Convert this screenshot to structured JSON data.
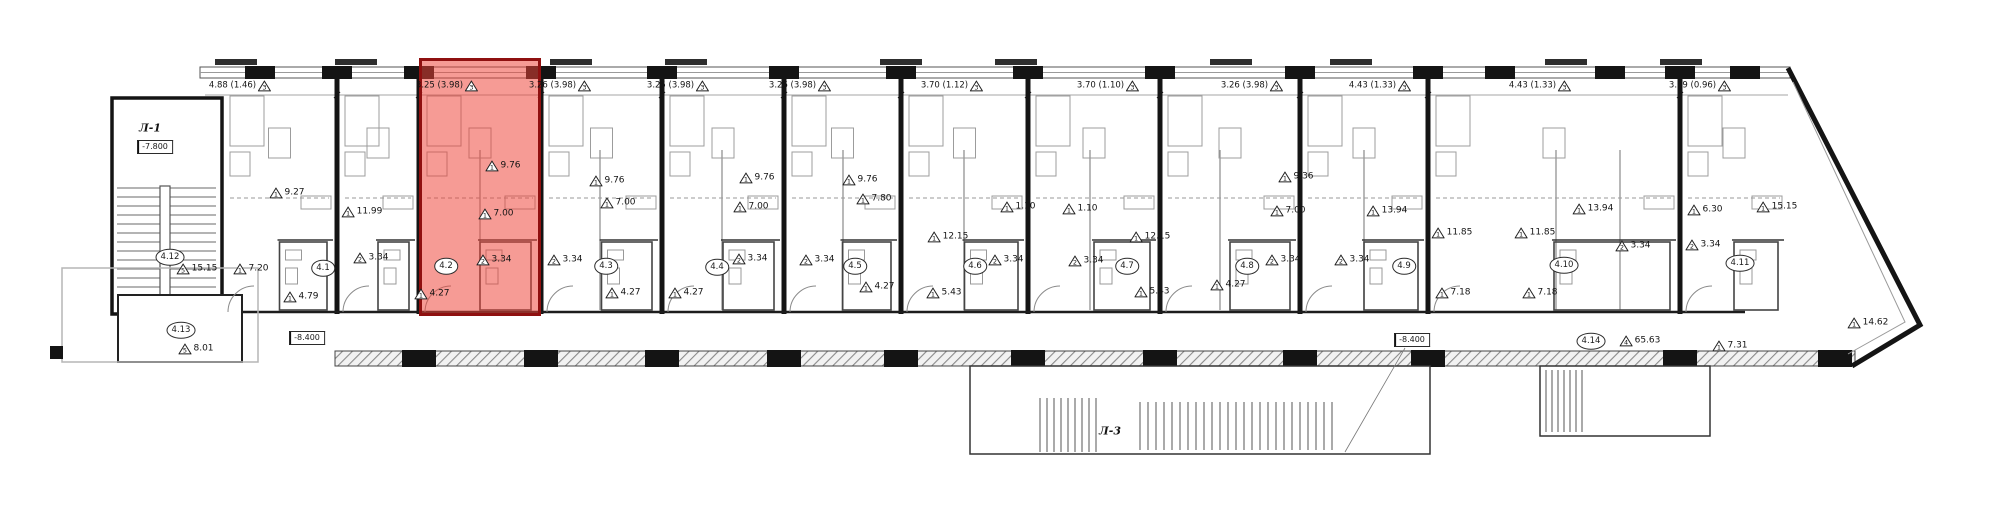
{
  "plan_title": "floor-plan-with-highlighted-unit",
  "highlighted_unit": {
    "id": "4.2",
    "fill_color": "#ee4438",
    "border_color": "#8f1010",
    "fill_opacity": 0.5
  },
  "stairwells": {
    "left": {
      "label": "Л-1",
      "elevation": "-7.800",
      "x": 150,
      "y": 128,
      "elev_x": 155,
      "elev_y": 147
    },
    "bottom": {
      "label": "Л-3",
      "x": 1110,
      "y": 431
    }
  },
  "elevations": [
    {
      "text": "-8.400",
      "x": 307,
      "y": 338
    },
    {
      "text": "-8.400",
      "x": 1412,
      "y": 340
    }
  ],
  "top_dimensions": [
    {
      "text": "4.88 (1.46)",
      "tri": "3",
      "x": 240
    },
    {
      "text": "3.25 (3.98)",
      "tri": "3",
      "x": 447
    },
    {
      "text": "3.26 (3.98)",
      "tri": "3",
      "x": 560
    },
    {
      "text": "3.25 (3.98)",
      "tri": "3",
      "x": 678
    },
    {
      "text": "3.26 (3.98)",
      "tri": "3",
      "x": 800
    },
    {
      "text": "3.70 (1.12)",
      "tri": "3",
      "x": 952
    },
    {
      "text": "3.70 (1.10)",
      "tri": "3",
      "x": 1108
    },
    {
      "text": "3.26 (3.98)",
      "tri": "3",
      "x": 1252
    },
    {
      "text": "4.43 (1.33)",
      "tri": "3",
      "x": 1380
    },
    {
      "text": "4.43 (1.33)",
      "tri": "3",
      "x": 1540
    },
    {
      "text": "3.99 (0.96)",
      "tri": "3",
      "x": 1700
    }
  ],
  "unit_markers": [
    {
      "id": "4.1",
      "x": 323,
      "y": 268
    },
    {
      "id": "4.2",
      "x": 446,
      "y": 266
    },
    {
      "id": "4.3",
      "x": 606,
      "y": 266
    },
    {
      "id": "4.4",
      "x": 717,
      "y": 267
    },
    {
      "id": "4.5",
      "x": 855,
      "y": 266
    },
    {
      "id": "4.6",
      "x": 975,
      "y": 266
    },
    {
      "id": "4.7",
      "x": 1127,
      "y": 266
    },
    {
      "id": "4.8",
      "x": 1247,
      "y": 266
    },
    {
      "id": "4.9",
      "x": 1404,
      "y": 266
    },
    {
      "id": "4.10",
      "x": 1564,
      "y": 265
    },
    {
      "id": "4.11",
      "x": 1740,
      "y": 263
    },
    {
      "id": "4.12",
      "x": 170,
      "y": 257
    },
    {
      "id": "4.13",
      "x": 181,
      "y": 330
    },
    {
      "id": "4.14",
      "x": 1591,
      "y": 341
    }
  ],
  "area_labels": [
    {
      "tri": "1",
      "text": "9.27",
      "x": 287,
      "y": 193
    },
    {
      "tri": "1",
      "text": "11.99",
      "x": 362,
      "y": 212
    },
    {
      "tri": "1",
      "text": "7.20",
      "x": 251,
      "y": 269
    },
    {
      "tri": "1",
      "text": "4.79",
      "x": 301,
      "y": 297
    },
    {
      "tri": "2",
      "text": "3.34",
      "x": 371,
      "y": 258
    },
    {
      "tri": "5",
      "text": "15.15",
      "x": 197,
      "y": 269
    },
    {
      "tri": "5",
      "text": "8.01",
      "x": 196,
      "y": 349
    },
    {
      "tri": "1",
      "text": "9.76",
      "x": 503,
      "y": 166
    },
    {
      "tri": "1",
      "text": "7.00",
      "x": 496,
      "y": 214
    },
    {
      "tri": "2",
      "text": "3.34",
      "x": 494,
      "y": 260
    },
    {
      "tri": "1",
      "text": "4.27",
      "x": 432,
      "y": 294
    },
    {
      "tri": "1",
      "text": "9.76",
      "x": 607,
      "y": 181
    },
    {
      "tri": "1",
      "text": "7.00",
      "x": 618,
      "y": 203
    },
    {
      "tri": "2",
      "text": "3.34",
      "x": 565,
      "y": 260
    },
    {
      "tri": "1",
      "text": "4.27",
      "x": 623,
      "y": 293
    },
    {
      "tri": "1",
      "text": "9.76",
      "x": 757,
      "y": 178
    },
    {
      "tri": "1",
      "text": "7.00",
      "x": 751,
      "y": 207
    },
    {
      "tri": "2",
      "text": "3.34",
      "x": 750,
      "y": 259
    },
    {
      "tri": "1",
      "text": "4.27",
      "x": 686,
      "y": 293
    },
    {
      "tri": "1",
      "text": "9.76",
      "x": 860,
      "y": 180
    },
    {
      "tri": "1",
      "text": "7.80",
      "x": 874,
      "y": 199
    },
    {
      "tri": "2",
      "text": "3.34",
      "x": 817,
      "y": 260
    },
    {
      "tri": "1",
      "text": "4.27",
      "x": 877,
      "y": 287
    },
    {
      "tri": "1",
      "text": "12.15",
      "x": 948,
      "y": 237
    },
    {
      "tri": "1",
      "text": "5.43",
      "x": 944,
      "y": 293
    },
    {
      "tri": "2",
      "text": "3.34",
      "x": 1006,
      "y": 260
    },
    {
      "tri": "1",
      "text": "1.10",
      "x": 1018,
      "y": 207
    },
    {
      "tri": "1",
      "text": "12.15",
      "x": 1150,
      "y": 237
    },
    {
      "tri": "1",
      "text": "5.43",
      "x": 1152,
      "y": 292
    },
    {
      "tri": "2",
      "text": "3.34",
      "x": 1086,
      "y": 261
    },
    {
      "tri": "1",
      "text": "1.10",
      "x": 1080,
      "y": 209
    },
    {
      "tri": "1",
      "text": "4.27",
      "x": 1228,
      "y": 285
    },
    {
      "tri": "1",
      "text": "9.36",
      "x": 1296,
      "y": 177
    },
    {
      "tri": "1",
      "text": "7.00",
      "x": 1288,
      "y": 211
    },
    {
      "tri": "2",
      "text": "3.34",
      "x": 1283,
      "y": 260
    },
    {
      "tri": "1",
      "text": "13.94",
      "x": 1387,
      "y": 211
    },
    {
      "tri": "2",
      "text": "3.34",
      "x": 1352,
      "y": 260
    },
    {
      "tri": "1",
      "text": "11.85",
      "x": 1452,
      "y": 233
    },
    {
      "tri": "1",
      "text": "11.85",
      "x": 1535,
      "y": 233
    },
    {
      "tri": "1",
      "text": "13.94",
      "x": 1593,
      "y": 209
    },
    {
      "tri": "1",
      "text": "7.18",
      "x": 1453,
      "y": 293
    },
    {
      "tri": "1",
      "text": "7.18",
      "x": 1540,
      "y": 293
    },
    {
      "tri": "2",
      "text": "3.34",
      "x": 1633,
      "y": 246
    },
    {
      "tri": "1",
      "text": "6.30",
      "x": 1705,
      "y": 210
    },
    {
      "tri": "1",
      "text": "15.15",
      "x": 1777,
      "y": 207
    },
    {
      "tri": "1",
      "text": "14.62",
      "x": 1868,
      "y": 323
    },
    {
      "tri": "1",
      "text": "7.31",
      "x": 1730,
      "y": 346
    },
    {
      "tri": "2",
      "text": "3.34",
      "x": 1703,
      "y": 245
    },
    {
      "tri": "4",
      "text": "65.63",
      "x": 1640,
      "y": 341
    }
  ]
}
